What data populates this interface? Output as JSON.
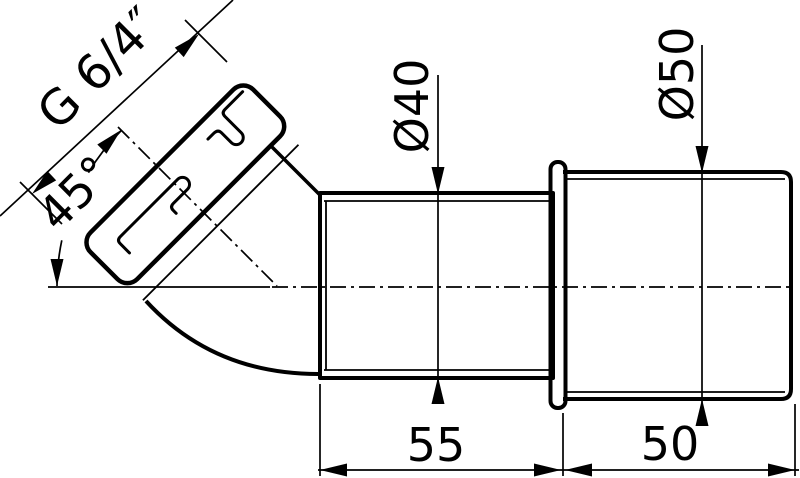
{
  "drawing": {
    "type": "technical-dimension-drawing",
    "subject": "45-degree pipe fitting adapter, side section view",
    "background_color": "#ffffff",
    "line_color": "#000000",
    "dimensions": {
      "thread": "G 6/4″",
      "angle": "45°",
      "inlet_diameter": "Ø40",
      "outlet_diameter": "Ø50",
      "inlet_length": "55",
      "outlet_length": "50"
    }
  }
}
